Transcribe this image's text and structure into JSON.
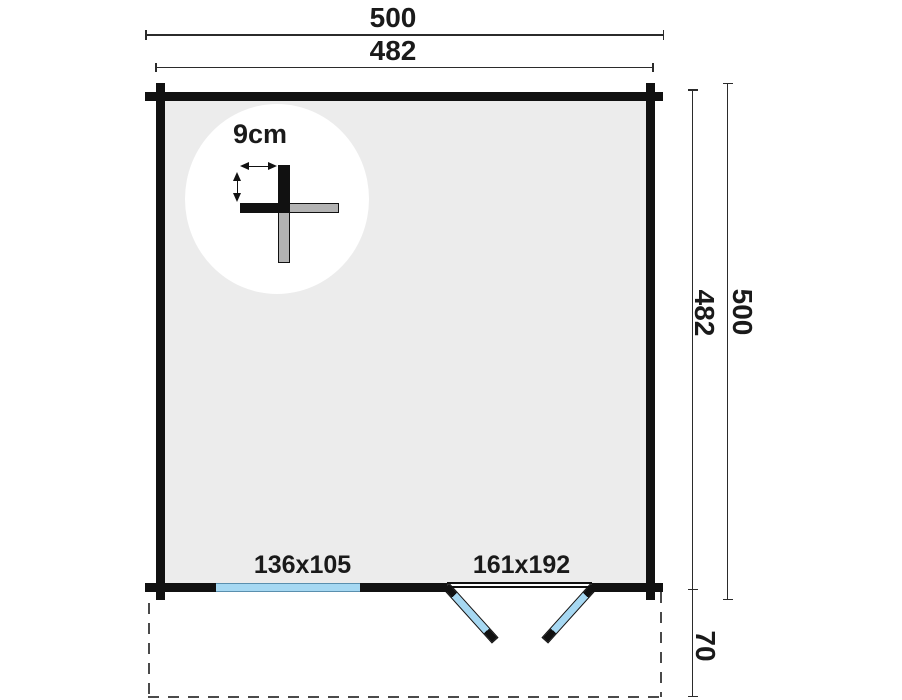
{
  "diagram": {
    "type": "log-cabin floor plan, top view",
    "dimensions": {
      "width_outer": "500",
      "width_inner": "482",
      "depth_inner": "482",
      "depth_outer": "500",
      "overhang_depth": "70"
    },
    "features": {
      "window_size": "136x105",
      "door_size": "161x192",
      "wall_thickness": "9cm"
    },
    "icons": {
      "thickness_width_arrow": "double-headed horizontal arrow",
      "thickness_height_arrow": "double-headed vertical arrow"
    },
    "colors": {
      "wall": "#111111",
      "floor": "#ececec",
      "glass": "#a6d8f2",
      "detail_gray": "#b3b3b3",
      "dimline": "#2b2b2b",
      "dash": "#4a4a4a",
      "text": "#1a1a1a"
    }
  }
}
